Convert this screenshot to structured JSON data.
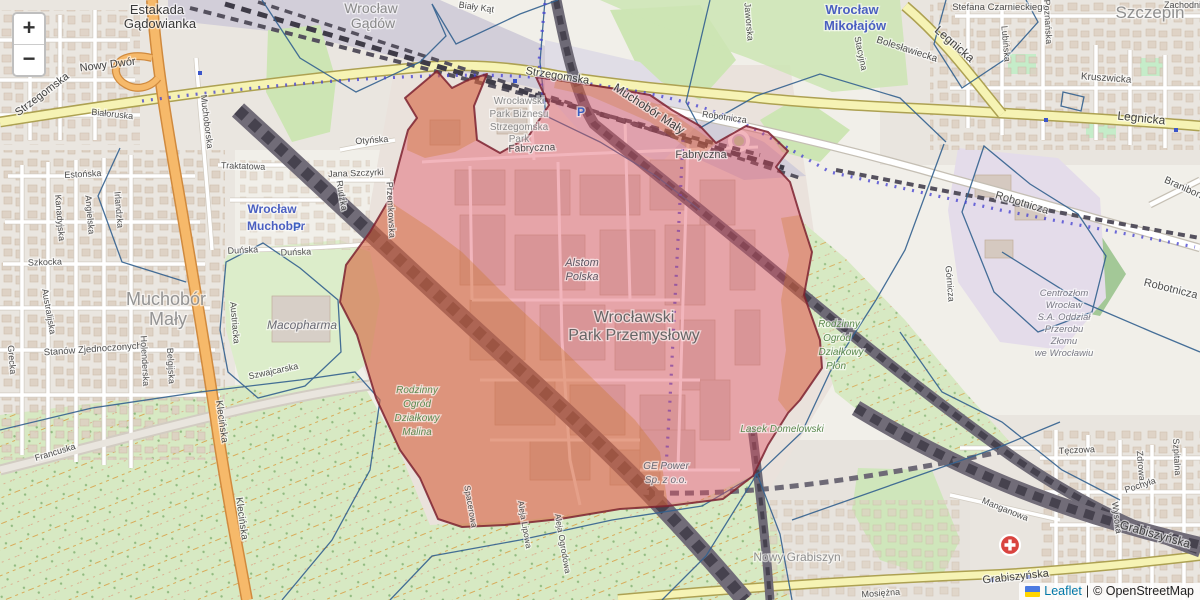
{
  "map": {
    "controls": {
      "zoom_in": "+",
      "zoom_out": "−"
    },
    "attribution": {
      "leaflet_label": "Leaflet",
      "separator": "|",
      "osm_label": "© OpenStreetMap",
      "flag_colors": [
        "#4c7be1",
        "#ffd500"
      ]
    },
    "overlay": {
      "highlight_fill": "#e04f5f",
      "highlight_border": "#7d2230",
      "secondary_tint": "#c9731e",
      "boundary_line": "#33618f",
      "route_dots": "#4a46d2"
    },
    "markers": {
      "hospital_icon_color": "#d9443f",
      "parking_glyph": "P",
      "station_color": "#4a5fc1"
    },
    "labels": [
      {
        "t": "Estakada",
        "x": 157,
        "y": 14,
        "s": 13,
        "c": "#3a3a3a"
      },
      {
        "t": "Gądowianka",
        "x": 160,
        "y": 28,
        "s": 13,
        "c": "#3a3a3a"
      },
      {
        "t": "Wrocław",
        "x": 371,
        "y": 13,
        "s": 14,
        "c": "#8a8a8a"
      },
      {
        "t": "Gądów",
        "x": 373,
        "y": 28,
        "s": 14,
        "c": "#8a8a8a"
      },
      {
        "t": "Biały Kąt",
        "x": 476,
        "y": 10,
        "r": 8,
        "s": 9
      },
      {
        "t": "Strzegomska",
        "x": 44,
        "y": 97,
        "r": -37,
        "s": 11,
        "c": "#424242"
      },
      {
        "t": "Nowy Dwór",
        "x": 108,
        "y": 68,
        "r": -7,
        "s": 11,
        "c": "#424242"
      },
      {
        "t": "Strzegomska",
        "x": 557,
        "y": 79,
        "r": 9,
        "s": 11,
        "c": "#424242"
      },
      {
        "t": "Muchoborska",
        "x": 204,
        "y": 122,
        "r": 83,
        "s": 9
      },
      {
        "t": "Muchobór Mały",
        "x": 647,
        "y": 112,
        "r": 33,
        "s": 12,
        "c": "#3f3f3f"
      },
      {
        "t": "Fabryczna",
        "x": 532,
        "y": 151,
        "r": -2,
        "s": 10
      },
      {
        "t": "Fabryczna",
        "x": 701,
        "y": 158,
        "s": 11
      },
      {
        "t": "Robotnicza",
        "x": 724,
        "y": 120,
        "r": 8,
        "s": 9
      },
      {
        "t": "Robotnicza",
        "x": 1021,
        "y": 206,
        "r": 17,
        "s": 11
      },
      {
        "t": "Robotnicza",
        "x": 1170,
        "y": 292,
        "r": 14,
        "s": 11
      },
      {
        "t": "Wrocław",
        "x": 852,
        "y": 14,
        "s": 13,
        "c": "#4a5fc1",
        "b": true
      },
      {
        "t": "Mikołajów",
        "x": 855,
        "y": 30,
        "s": 13,
        "c": "#4a5fc1",
        "b": true
      },
      {
        "t": "Stacyjna",
        "x": 858,
        "y": 54,
        "r": 78,
        "s": 9
      },
      {
        "t": "Bolesławiecka",
        "x": 906,
        "y": 52,
        "r": 18,
        "s": 10
      },
      {
        "t": "Jaworska",
        "x": 746,
        "y": 22,
        "r": 85,
        "s": 9
      },
      {
        "t": "Legnicka",
        "x": 952,
        "y": 47,
        "r": 41,
        "s": 12,
        "c": "#424242"
      },
      {
        "t": "Legnicka",
        "x": 1141,
        "y": 122,
        "r": 6,
        "s": 12,
        "c": "#424242"
      },
      {
        "t": "Szczepin",
        "x": 1150,
        "y": 18,
        "s": 17,
        "c": "#8f8f8f"
      },
      {
        "t": "Stefana Czarnieckiego",
        "x": 1000,
        "y": 10,
        "s": 9.5
      },
      {
        "t": "Lubińska",
        "x": 1003,
        "y": 44,
        "r": 85,
        "s": 9
      },
      {
        "t": "Poznańska",
        "x": 1045,
        "y": 22,
        "r": 87,
        "s": 9
      },
      {
        "t": "Kruszwicka",
        "x": 1106,
        "y": 81,
        "r": 4,
        "s": 10
      },
      {
        "t": "Zachodnia",
        "x": 1185,
        "y": 8,
        "s": 9
      },
      {
        "t": "Traktatowa",
        "x": 243,
        "y": 169,
        "r": 2,
        "s": 9
      },
      {
        "t": "Estońska",
        "x": 83,
        "y": 177,
        "r": -3,
        "s": 9
      },
      {
        "t": "Białoruska",
        "x": 112,
        "y": 117,
        "r": 6,
        "s": 9
      },
      {
        "t": "Kanadyjska",
        "x": 57,
        "y": 218,
        "r": 85,
        "s": 9
      },
      {
        "t": "Angielska",
        "x": 87,
        "y": 215,
        "r": 85,
        "s": 9
      },
      {
        "t": "Irlandzka",
        "x": 116,
        "y": 210,
        "r": 85,
        "s": 9
      },
      {
        "t": "Szkocka",
        "x": 45,
        "y": 265,
        "r": -2,
        "s": 9
      },
      {
        "t": "Australijska",
        "x": 46,
        "y": 312,
        "r": 80,
        "s": 9
      },
      {
        "t": "Grecka",
        "x": 9,
        "y": 360,
        "r": 85,
        "s": 9
      },
      {
        "t": "Stanów Zjednoczonych",
        "x": 93,
        "y": 352,
        "r": -4,
        "s": 9.5
      },
      {
        "t": "Holenderska",
        "x": 142,
        "y": 361,
        "r": 87,
        "s": 9
      },
      {
        "t": "Belgijska",
        "x": 168,
        "y": 366,
        "r": 87,
        "s": 9
      },
      {
        "t": "Francuska",
        "x": 56,
        "y": 455,
        "r": -17,
        "s": 9
      },
      {
        "t": "Klecińska",
        "x": 219,
        "y": 422,
        "r": 82,
        "s": 10
      },
      {
        "t": "Klecińska",
        "x": 239,
        "y": 519,
        "r": 82,
        "s": 10
      },
      {
        "t": "Muchobór",
        "x": 166,
        "y": 305,
        "s": 18,
        "c": "#949494"
      },
      {
        "t": "Mały",
        "x": 168,
        "y": 325,
        "s": 18,
        "c": "#949494"
      },
      {
        "t": "Wrocław",
        "x": 272,
        "y": 213,
        "s": 12,
        "c": "#4a5fc1",
        "b": true
      },
      {
        "t": "Muchobor",
        "x": 276,
        "y": 230,
        "s": 12,
        "c": "#4a5fc1",
        "b": true
      },
      {
        "t": "Otyńska",
        "x": 372,
        "y": 143,
        "r": -4,
        "s": 9
      },
      {
        "t": "Jana Szczyrki",
        "x": 356,
        "y": 176,
        "r": -2,
        "s": 9
      },
      {
        "t": "Rudzka",
        "x": 339,
        "y": 196,
        "r": 80,
        "s": 9
      },
      {
        "t": "Przemkowska",
        "x": 388,
        "y": 210,
        "r": 87,
        "s": 9
      },
      {
        "t": "Duńska",
        "x": 243,
        "y": 253,
        "r": -3,
        "s": 9
      },
      {
        "t": "Duńska",
        "x": 296,
        "y": 255,
        "r": -2,
        "s": 9
      },
      {
        "t": "Austriacka",
        "x": 232,
        "y": 323,
        "r": 85,
        "s": 9
      },
      {
        "t": "Macopharma",
        "x": 302,
        "y": 329,
        "s": 12,
        "c": "#6b6b75",
        "i": true
      },
      {
        "t": "Szwajcarska",
        "x": 274,
        "y": 374,
        "r": -12,
        "s": 9
      },
      {
        "t": "Wrocławski",
        "x": 519,
        "y": 104,
        "s": 10,
        "c": "#8a8a8a"
      },
      {
        "t": "Park Biznesu",
        "x": 519,
        "y": 117,
        "s": 10,
        "c": "#8a8a8a"
      },
      {
        "t": "Strzegomska",
        "x": 519,
        "y": 130,
        "s": 10,
        "c": "#8a8a8a"
      },
      {
        "t": "Park",
        "x": 519,
        "y": 142,
        "s": 10,
        "c": "#8a8a8a"
      },
      {
        "t": "Alstom",
        "x": 582,
        "y": 266,
        "s": 11,
        "c": "#5f5864",
        "i": true
      },
      {
        "t": "Polska",
        "x": 582,
        "y": 280,
        "s": 11,
        "c": "#5f5864",
        "i": true
      },
      {
        "t": "Wrocławski",
        "x": 634,
        "y": 322,
        "s": 16,
        "c": "#666666"
      },
      {
        "t": "Park Przemysłowy",
        "x": 634,
        "y": 340,
        "s": 16,
        "c": "#666666"
      },
      {
        "t": "Rodzinny",
        "x": 417,
        "y": 393,
        "s": 10,
        "c": "#5c8a50",
        "i": true
      },
      {
        "t": "Ogród",
        "x": 417,
        "y": 407,
        "s": 10,
        "c": "#5c8a50",
        "i": true
      },
      {
        "t": "Działkowy",
        "x": 417,
        "y": 421,
        "s": 10,
        "c": "#5c8a50",
        "i": true
      },
      {
        "t": "Malina",
        "x": 417,
        "y": 435,
        "s": 10,
        "c": "#5c8a50",
        "i": true
      },
      {
        "t": "GE Power",
        "x": 666,
        "y": 469,
        "s": 10,
        "c": "#6b6b75",
        "i": true
      },
      {
        "t": "Sp. z o.o.",
        "x": 666,
        "y": 483,
        "s": 10,
        "c": "#6b6b75",
        "i": true
      },
      {
        "t": "Rodzinny",
        "x": 839,
        "y": 327,
        "s": 10,
        "c": "#5c8a50",
        "i": true
      },
      {
        "t": "Ogród",
        "x": 837,
        "y": 341,
        "s": 10,
        "c": "#5c8a50",
        "i": true
      },
      {
        "t": "Działkowy",
        "x": 841,
        "y": 355,
        "s": 10,
        "c": "#5c8a50",
        "i": true
      },
      {
        "t": "Płon",
        "x": 836,
        "y": 369,
        "s": 10,
        "c": "#5c8a50",
        "i": true
      },
      {
        "t": "Lasek Domelowski",
        "x": 782,
        "y": 432,
        "s": 10,
        "c": "#5c8a50",
        "i": true
      },
      {
        "t": "Centrozłom",
        "x": 1064,
        "y": 296,
        "s": 9.5,
        "c": "#7a7a85",
        "i": true
      },
      {
        "t": "Wrocław",
        "x": 1064,
        "y": 308,
        "s": 9.5,
        "c": "#7a7a85",
        "i": true
      },
      {
        "t": "S.A. Oddział",
        "x": 1064,
        "y": 320,
        "s": 9.5,
        "c": "#7a7a85",
        "i": true
      },
      {
        "t": "Przerobu",
        "x": 1064,
        "y": 332,
        "s": 9.5,
        "c": "#7a7a85",
        "i": true
      },
      {
        "t": "Złomu",
        "x": 1064,
        "y": 344,
        "s": 9.5,
        "c": "#7a7a85",
        "i": true
      },
      {
        "t": "we Wrocławiu",
        "x": 1064,
        "y": 356,
        "s": 9.5,
        "c": "#7a7a85",
        "i": true
      },
      {
        "t": "Górnicza",
        "x": 947,
        "y": 284,
        "r": 85,
        "s": 9
      },
      {
        "t": "Braniborska",
        "x": 1188,
        "y": 193,
        "r": 24,
        "s": 10
      },
      {
        "t": "Tęczowa",
        "x": 1077,
        "y": 453,
        "r": -3,
        "s": 9
      },
      {
        "t": "Zdrowa",
        "x": 1138,
        "y": 466,
        "r": 85,
        "s": 9
      },
      {
        "t": "Pochyła",
        "x": 1141,
        "y": 488,
        "r": -18,
        "s": 9
      },
      {
        "t": "Szpitalna",
        "x": 1174,
        "y": 457,
        "r": 87,
        "s": 9
      },
      {
        "t": "Manganowa",
        "x": 1004,
        "y": 512,
        "r": 22,
        "s": 9
      },
      {
        "t": "Wysoka",
        "x": 1114,
        "y": 518,
        "r": 83,
        "s": 9
      },
      {
        "t": "Grabiszyńska",
        "x": 1154,
        "y": 538,
        "r": 16,
        "s": 12,
        "c": "#424242"
      },
      {
        "t": "Grabiszyńska",
        "x": 1016,
        "y": 580,
        "r": -6,
        "s": 11,
        "c": "#424242"
      },
      {
        "t": "Nowy Grabiszyn",
        "x": 797,
        "y": 561,
        "s": 12,
        "c": "#8f8f8f"
      },
      {
        "t": "Mosiężna",
        "x": 881,
        "y": 596,
        "r": -4,
        "s": 9
      },
      {
        "t": "Spacerowa",
        "x": 468,
        "y": 507,
        "r": 80,
        "s": 8.5
      },
      {
        "t": "Aleja Lipowa",
        "x": 522,
        "y": 525,
        "r": 80,
        "s": 8.5
      },
      {
        "t": "Aleja Ogrodowa",
        "x": 560,
        "y": 544,
        "r": 80,
        "s": 8.5
      },
      {
        "t": "P",
        "x": 297,
        "y": 231,
        "s": 12,
        "c": "#3b5fc0",
        "b": true
      },
      {
        "t": "P",
        "x": 581,
        "y": 116,
        "s": 12,
        "c": "#3b5fc0",
        "b": true
      }
    ]
  }
}
